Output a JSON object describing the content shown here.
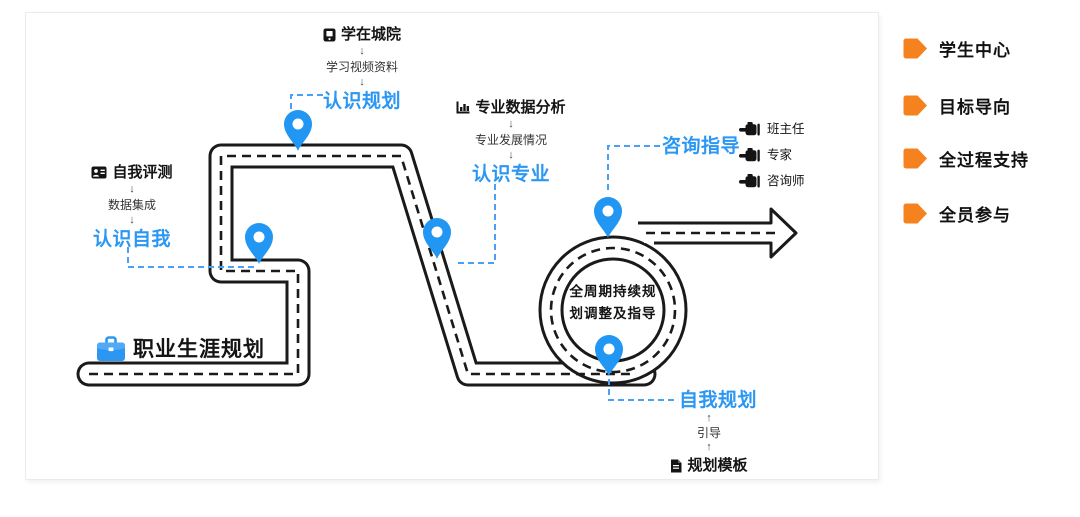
{
  "colors": {
    "accent_blue": "#2b97f3",
    "connector_blue": "#4aa0f7",
    "road_black": "#1a1a1a",
    "sidebar_orange": "#f5821f"
  },
  "glyphs": {
    "down_arrow": "↓",
    "up_arrow": "↑"
  },
  "road": {
    "start_label": "职业生涯规划",
    "start_icon": "briefcase-icon",
    "loop_label_line1": "全周期持续规",
    "loop_label_line2": "划调整及指导"
  },
  "stages": {
    "know_self": {
      "source": "自我评测",
      "source_icon": "id-card-icon",
      "via": "数据集成",
      "result": "认识自我"
    },
    "know_planning": {
      "source": "学在城院",
      "source_icon": "mobile-learning-icon",
      "via": "学习视频资料",
      "result": "认识规划"
    },
    "know_major": {
      "source": "专业数据分析",
      "source_icon": "bar-chart-icon",
      "via": "专业发展情况",
      "result": "认识专业"
    },
    "consulting": {
      "result": "咨询指导",
      "consultants": [
        "班主任",
        "专家",
        "咨询师"
      ]
    },
    "self_planning": {
      "result": "自我规划",
      "via": "引导",
      "source": "规划模板",
      "source_icon": "document-icon"
    }
  },
  "sidebar": {
    "items": [
      {
        "label": "学生中心"
      },
      {
        "label": "目标导向"
      },
      {
        "label": "全过程支持"
      },
      {
        "label": "全员参与"
      }
    ]
  }
}
